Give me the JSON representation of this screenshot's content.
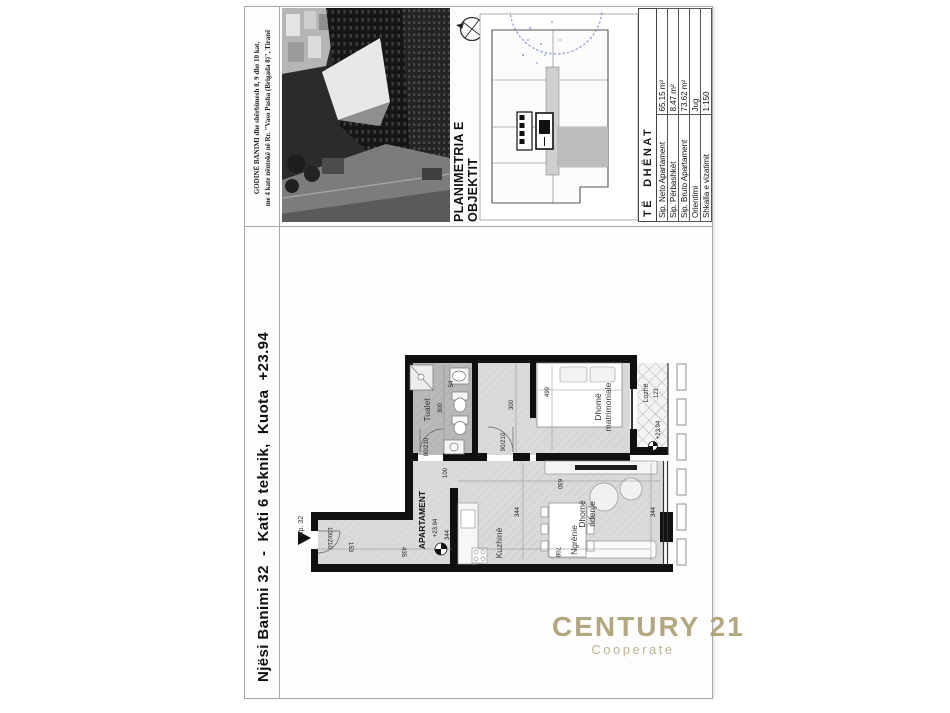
{
  "document": {
    "building_caption": {
      "line1": "GODINË BANIMI dhe shërbimesh 8, 9 dhe 10 kat,",
      "line2": "me 4 kate nëntokë në Rr. \"Vaso Pasha (Brigada 8)\", Tiranë"
    },
    "section_title": "PLANIMETRIA E OBJEKTIT",
    "unit_title": "Njësi Banimi 32  -  Kati 6 teknik,  Kuota  +23.94",
    "data_table": {
      "title": "TË  DHËNAT",
      "rows": [
        {
          "label": "Sip. Neto Apartament",
          "value": "65.15 m²"
        },
        {
          "label": "Sip. Përbashkët",
          "value": "8.47 m²"
        },
        {
          "label": "Sip. Bruto Apartament",
          "value": "73.62 m²"
        },
        {
          "label": "Orientimi",
          "value": "Jug"
        },
        {
          "label": "Shkalla e vizatimit",
          "value": "1:150"
        }
      ]
    },
    "watermark": {
      "brand": "CENTURY 21",
      "sub": "Cooperate"
    }
  },
  "floor_plan": {
    "unit_tag": "Ap. 32",
    "apartment_label": "APARTAMENT",
    "apartment_level": "+23.94",
    "rooms": {
      "bathroom": "Tualet",
      "bedroom_l1": "Dhomë",
      "bedroom_l2": "matrimoniale",
      "balcony": "Lozhë",
      "kitchen": "Kuzhinë",
      "dining": "Ngrënie",
      "living_l1": "Dhomë",
      "living_l2": "ndenje"
    },
    "dimensions": {
      "entry_door": "100/210",
      "entry_seg": "153",
      "entry_len": "435",
      "bath_door": "80/210",
      "bath_len": "300",
      "bath_w": "54",
      "hall_door": "90/210",
      "hall_len": "300",
      "pass_w": "100",
      "bed_len": "499",
      "balcony_w": "121",
      "balcony_level": "+23.94",
      "living_len": "630",
      "kitchen_depth": "344",
      "facade_w": "344",
      "living_w": "708",
      "apt_dim": "344"
    }
  },
  "colors": {
    "accent_gold": "#ad9f74",
    "stamp_blue": "#4a63b8",
    "wall_black": "#101010"
  }
}
